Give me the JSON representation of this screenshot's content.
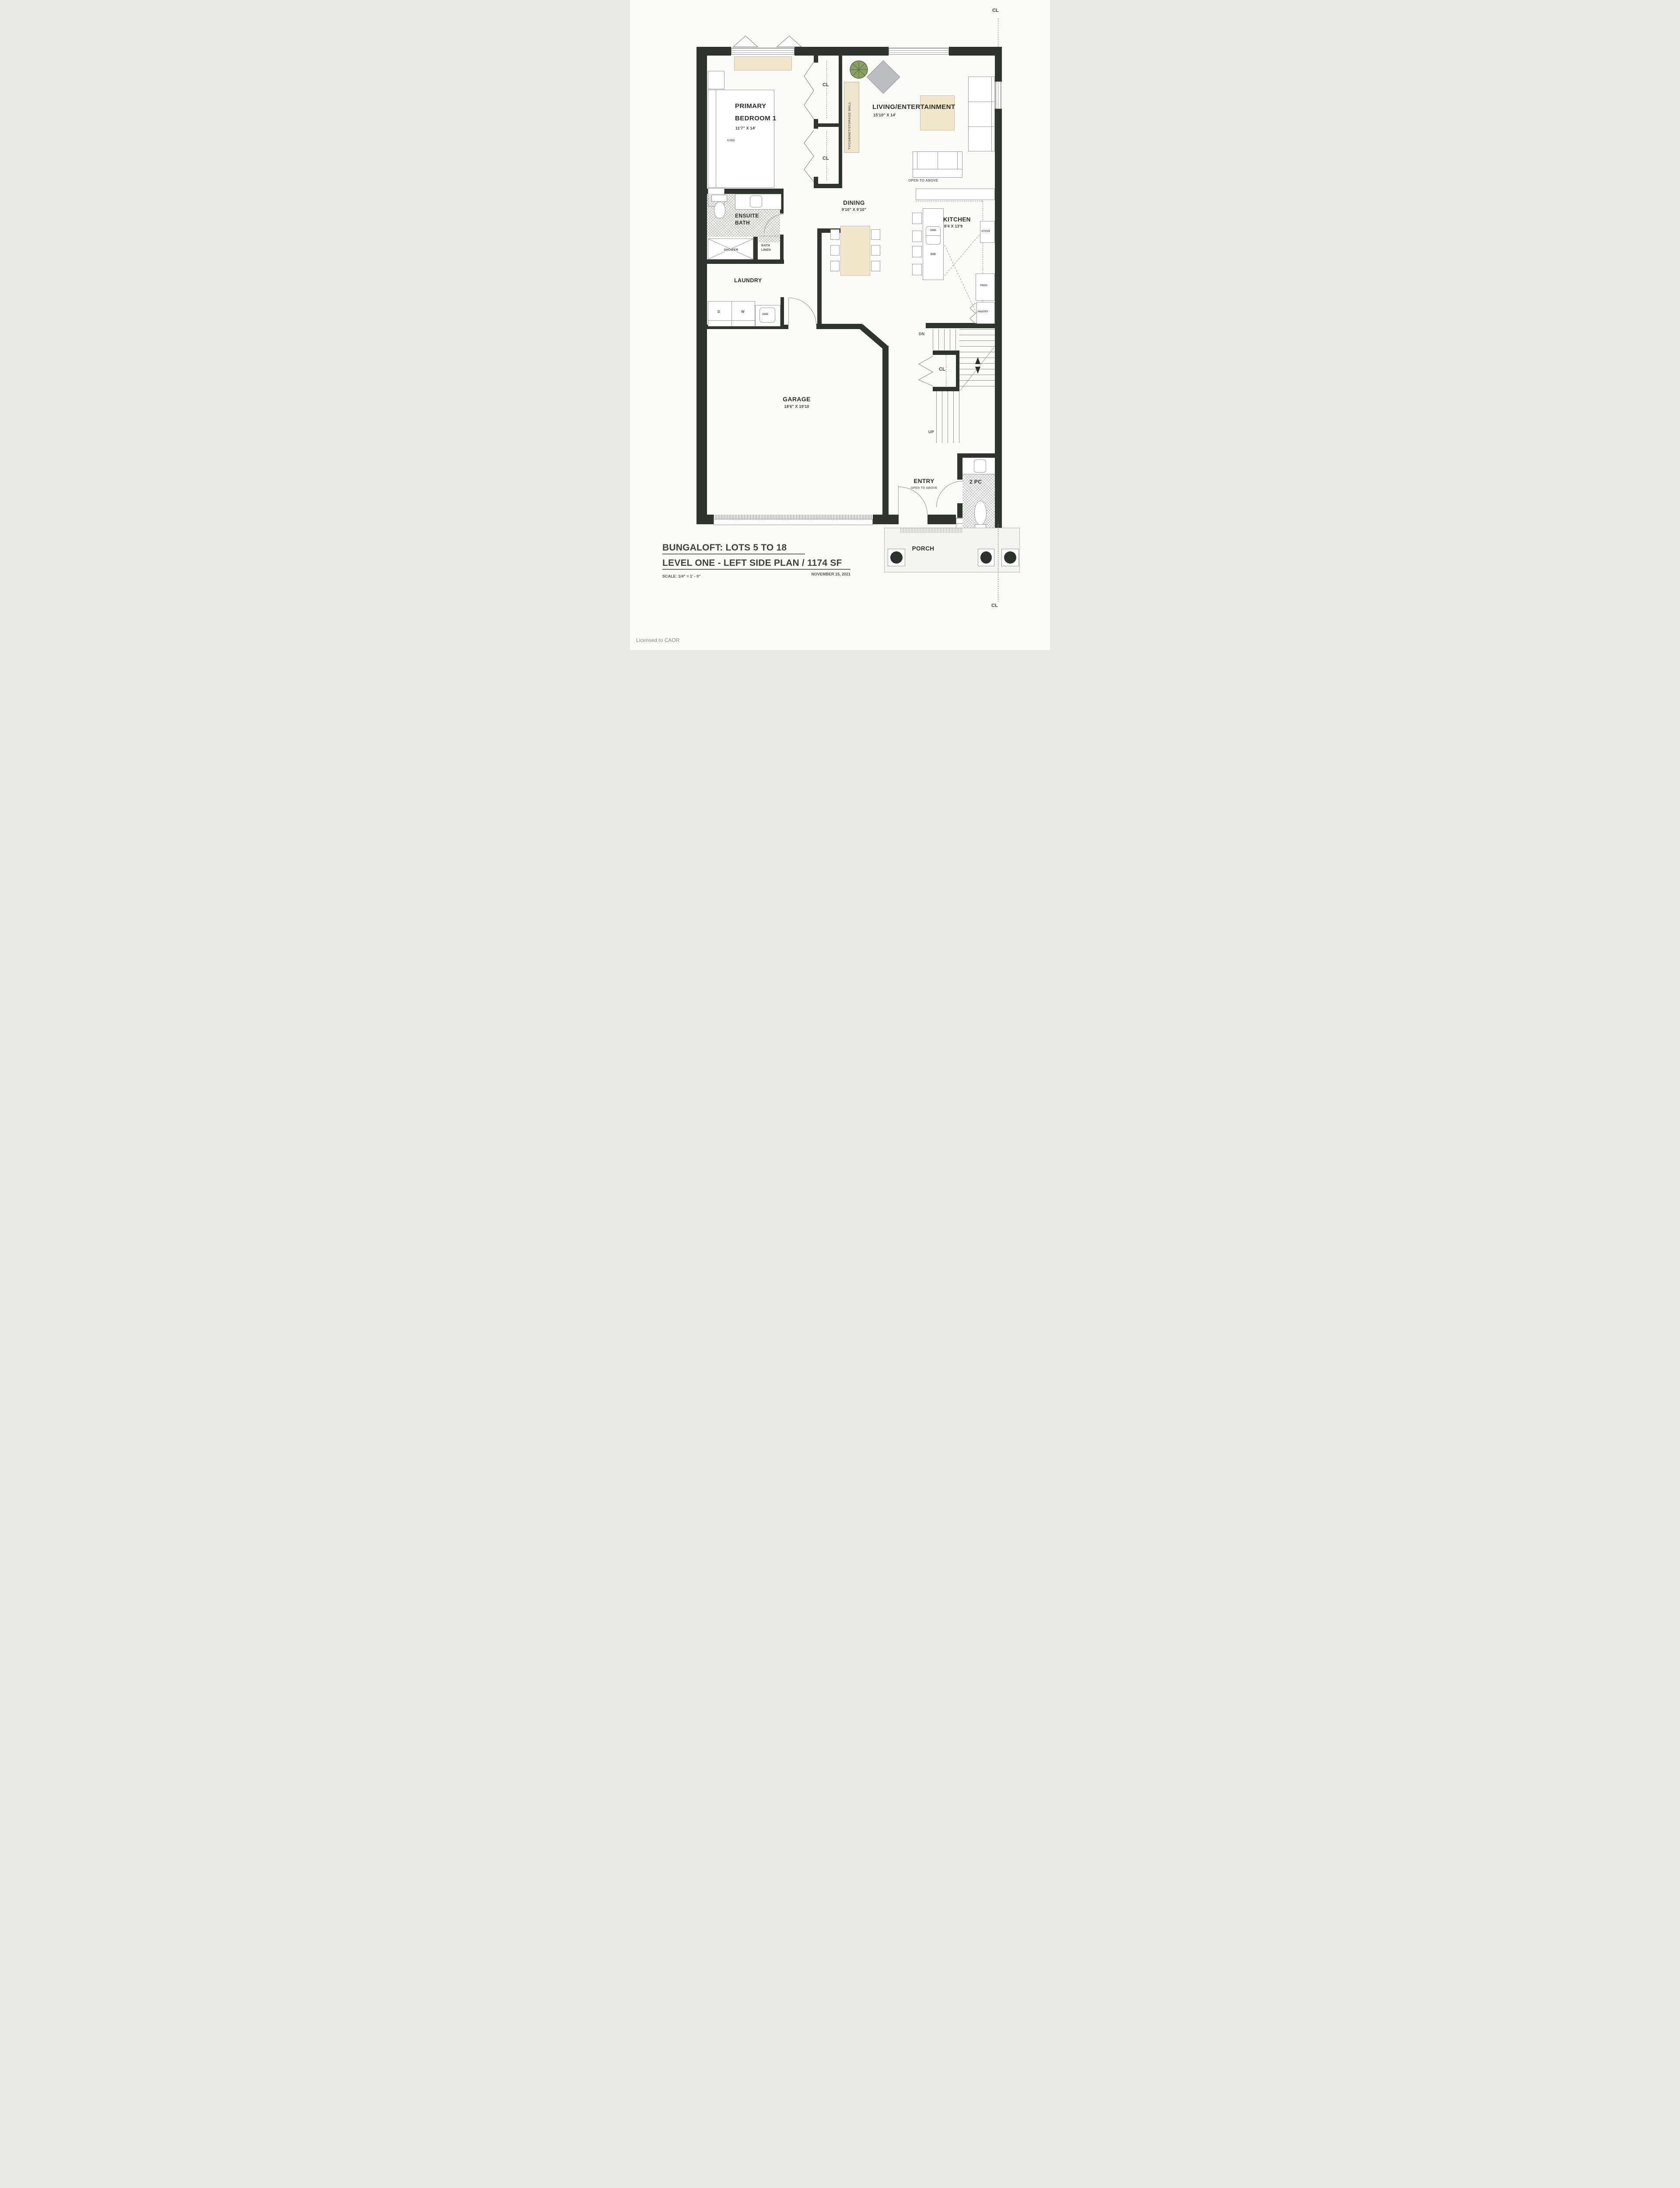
{
  "title": {
    "line1": "BUNGALOFT:  LOTS 5 TO 18",
    "line2": "LEVEL ONE - LEFT SIDE PLAN / 1174 SF",
    "scale": "SCALE:  1/4\" = 1' - 0\"",
    "date": "NOVEMBER 15, 2021"
  },
  "footer": {
    "license": "Licensed to CAOR"
  },
  "labels": {
    "cl_top": "CL",
    "cl_bottom": "CL",
    "primary_l1": "PRIMARY",
    "primary_l2": "BEDROOM 1",
    "primary_dims": "11'7\" X 14'",
    "king": "KING",
    "cl_closet_1": "CL",
    "cl_closet_2": "CL",
    "tv_wall": "TV/CABINET/STORAGE WALL",
    "living": "LIVING/ENTERTAINMENT",
    "living_dims": "15'10\" X 14'",
    "open_above_living": "OPEN TO ABOVE",
    "dining": "DINING",
    "dining_dims": "9'10\" X 9'10\"",
    "kitchen": "KITCHEN",
    "kitchen_dims": "8'4 X 13'9",
    "sink_island": "SINK",
    "dw": "DW",
    "stove": "STOVE",
    "frdg": "FRDG",
    "pantry": "PANTRY",
    "ensuite_l1": "ENSUITE",
    "ensuite_l2": "BATH",
    "shower": "SHOWER",
    "linen_l1": "BATH",
    "linen_l2": "LINEN",
    "laundry": "LAUNDRY",
    "d": "D",
    "w": "W",
    "sink_laundry": "SINK",
    "garage": "GARAGE",
    "garage_dims": "18'6\" X 19'10",
    "dn": "DN",
    "up": "UP",
    "cl_stairs": "CL",
    "entry": "ENTRY",
    "open_above_entry": "OPEN TO ABOVE",
    "twopc": "2 PC",
    "porch": "PORCH"
  }
}
